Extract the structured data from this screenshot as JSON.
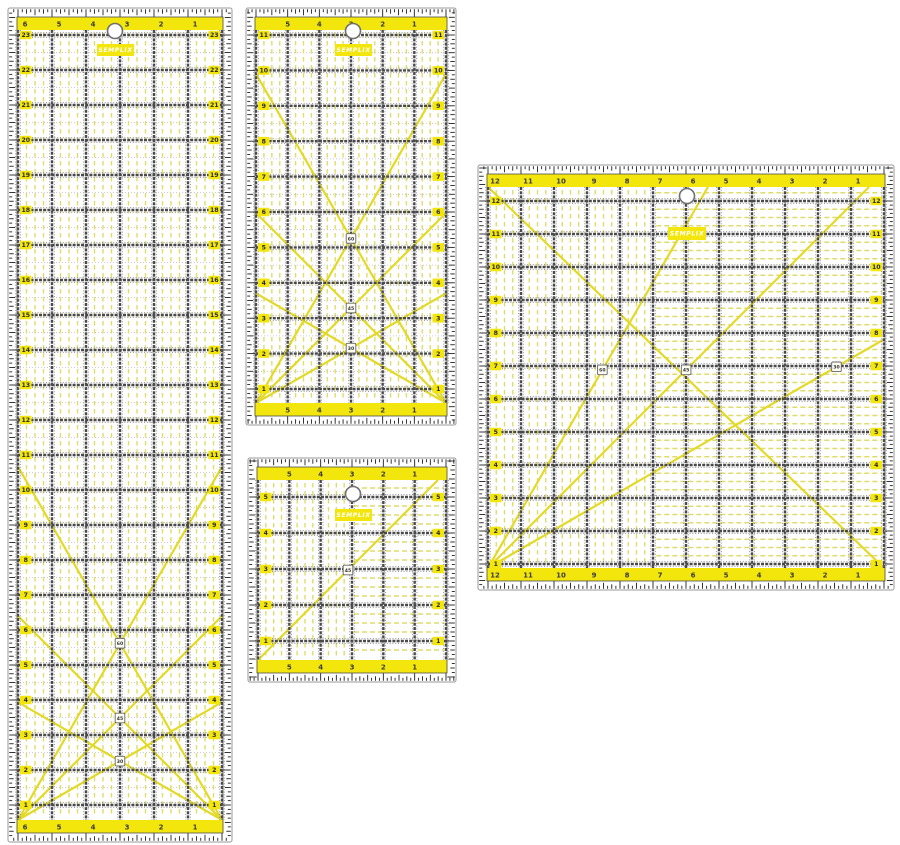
{
  "brand": "SEMPLIX",
  "background": "#ffffff",
  "colors": {
    "body": "#ffffff",
    "edge": "#9a9a9a",
    "inner_border": "#4f4f4f",
    "band_yellow": "#f2e60c",
    "pale_dash_yellow": "#e0dc6a",
    "diagonal_yellow": "#e3d928",
    "grid_dark": "#4a4a4a",
    "grid_flank": "#7d7d7d",
    "tick_black": "#1e1e1e",
    "number_dark": "#3a3a3a",
    "half_dot_gray": "#bdbdbd",
    "logo_bg": "#f2e60c",
    "logo_text": "#ffffff",
    "hole_stroke": "#707070",
    "marker_bg": "#fcfcf3",
    "marker_border": "#666666",
    "marker_text": "#333333"
  },
  "rulers": [
    {
      "id": "ruler-6x24-inch",
      "rect": {
        "x": 8,
        "y": 8,
        "w": 224,
        "h": 834
      },
      "cells_x": 6,
      "col_labels": [
        "6",
        "5",
        "4",
        "3",
        "2",
        "1"
      ],
      "col_line_start": 0,
      "col_label_mode": "after",
      "row_labels": [
        "23",
        "22",
        "21",
        "20",
        "19",
        "18",
        "17",
        "16",
        "15",
        "14",
        "13",
        "12",
        "11",
        "10",
        "9",
        "8",
        "7",
        "6",
        "5",
        "4",
        "3",
        "2",
        "1"
      ],
      "row_offset": 5,
      "row_end_offset": 15,
      "dash": {
        "mode": "vertical"
      },
      "hole": {
        "cx": 115,
        "cy": 31,
        "r": 7.5
      },
      "logo": {
        "x": 97,
        "y": 44,
        "w": 37,
        "h": 12
      },
      "diagonals": [
        {
          "from": "bl",
          "angle": 60,
          "marker": 0.5,
          "label": "60"
        },
        {
          "from": "bl",
          "angle": 45,
          "marker": 0.5,
          "label": "45"
        },
        {
          "from": "bl",
          "angle": 30,
          "marker": 0.5,
          "label": "30"
        },
        {
          "from": "br",
          "angle": 60
        },
        {
          "from": "br",
          "angle": 45
        },
        {
          "from": "br",
          "angle": 30
        }
      ]
    },
    {
      "id": "ruler-6x12-inch",
      "rect": {
        "x": 246,
        "y": 8,
        "w": 210,
        "h": 417
      },
      "cells_x": 6,
      "col_labels": [
        "5",
        "4",
        "3",
        "2",
        "1"
      ],
      "col_line_start": 1,
      "col_label_mode": "center",
      "row_labels": [
        "11",
        "10",
        "9",
        "8",
        "7",
        "6",
        "5",
        "4",
        "3",
        "2",
        "1"
      ],
      "row_offset": 5,
      "row_end_offset": 14,
      "dash": {
        "mode": "vertical"
      },
      "hole": {
        "cx": 353,
        "cy": 31,
        "r": 7.5
      },
      "logo": {
        "x": 335,
        "y": 44,
        "w": 37,
        "h": 12
      },
      "diagonals": [
        {
          "from": "bl",
          "angle": 60,
          "marker": 0.5,
          "label": "60"
        },
        {
          "from": "bl",
          "angle": 45,
          "marker": 0.5,
          "label": "45"
        },
        {
          "from": "bl",
          "angle": 30,
          "marker": 0.5,
          "label": "30"
        },
        {
          "from": "br",
          "angle": 60
        },
        {
          "from": "br",
          "angle": 45
        },
        {
          "from": "br",
          "angle": 30
        }
      ]
    },
    {
      "id": "ruler-6x6-inch",
      "rect": {
        "x": 248,
        "y": 458,
        "w": 208,
        "h": 224
      },
      "cells_x": 6,
      "col_labels": [
        "5",
        "4",
        "3",
        "2",
        "1"
      ],
      "col_line_start": 1,
      "col_label_mode": "center",
      "row_labels": [
        "5",
        "4",
        "3",
        "2",
        "1"
      ],
      "row_offset": 17,
      "row_end_offset": 19,
      "dash": {
        "mode": "split",
        "frac": 0.5
      },
      "hole": {
        "cx": 353,
        "cy": 494,
        "r": 7.5
      },
      "logo": {
        "x": 335,
        "y": 509,
        "w": 37,
        "h": 12
      },
      "diagonals": [
        {
          "from": "bl",
          "angle": 45,
          "marker": 0.5,
          "label": "45"
        }
      ]
    },
    {
      "id": "ruler-12x12-inch",
      "rect": {
        "x": 478,
        "y": 165,
        "w": 416,
        "h": 425
      },
      "cells_x": 12,
      "col_labels": [
        "12",
        "11",
        "10",
        "9",
        "8",
        "7",
        "6",
        "5",
        "4",
        "3",
        "2",
        "1"
      ],
      "col_line_start": 0,
      "col_label_mode": "after",
      "row_labels": [
        "12",
        "11",
        "10",
        "9",
        "8",
        "7",
        "6",
        "5",
        "4",
        "3",
        "2",
        "1"
      ],
      "row_offset": 14,
      "row_end_offset": 4,
      "dash": {
        "mode": "split",
        "frac": 0.42
      },
      "hole": {
        "cx": 687,
        "cy": 196,
        "r": 7.5
      },
      "logo": {
        "x": 668,
        "y": 227,
        "w": 38,
        "h": 13
      },
      "diagonals": [
        {
          "from": "tlbr"
        },
        {
          "from": "bl",
          "angle": 60,
          "marker": 0.52,
          "label": "60"
        },
        {
          "from": "bl",
          "angle": 45,
          "marker": 0.52,
          "label": "45"
        },
        {
          "from": "bl",
          "angle": 30,
          "marker": 0.88,
          "label": "30"
        }
      ]
    }
  ]
}
